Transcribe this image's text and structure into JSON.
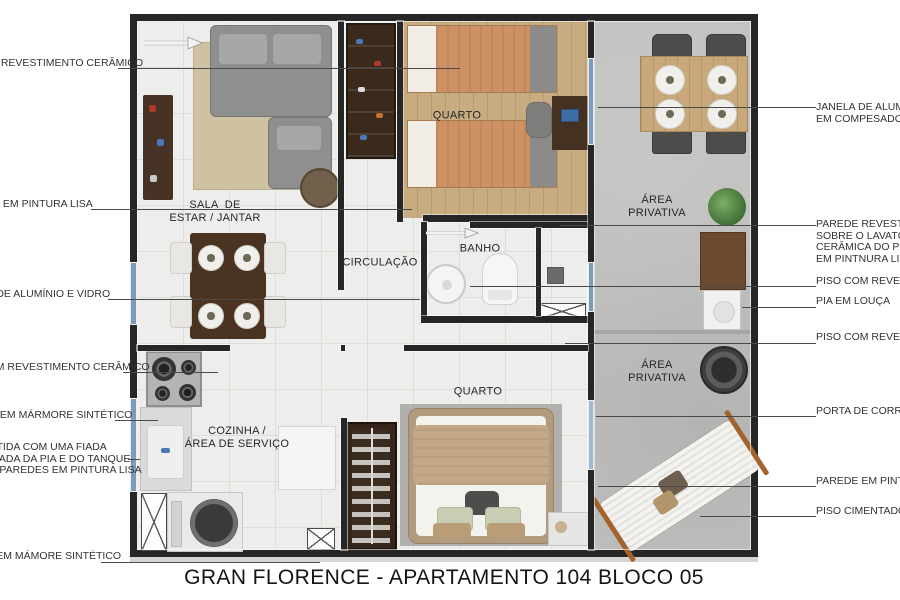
{
  "title": "GRAN FLORENCE - APARTAMENTO 104 BLOCO 05",
  "room_labels": {
    "quarto_top": "QUARTO",
    "sala": "SALA  DE\nESTAR / JANTAR",
    "circulacao": "CIRCULAÇÃO",
    "banho": "BANHO",
    "area_privativa_top": "ÁREA\nPRIVATIVA",
    "area_privativa_mid": "ÁREA\nPRIVATIVA",
    "cozinha": "COZINHA /\nÁREA DE SERVIÇO",
    "quarto_bottom": "QUARTO"
  },
  "annotations_left": [
    {
      "text": "OM REVESTIMENTO CERÂMICO"
    },
    {
      "text": "E EM PINTURA LISA"
    },
    {
      "text": "A DE ALUMÍNIO E VIDRO"
    },
    {
      "text": "COM REVESTIMENTO CERÂMICO"
    },
    {
      "text": "DA EM MÁRMORE SINTÉTICO"
    },
    {
      "text": "E REVESTIDA COM UMA FIADA\nE A BANCADA DA PIA E DO TANQUE.\nNTE DAS PAREDES EM PINTURA LISA"
    },
    {
      "text": "NQUE EM MÁMORE SINTÉTICO"
    }
  ],
  "annotations_right": [
    {
      "text": "JANELA DE ALUMÍNIO E\nEM COMPESADO DE MA"
    },
    {
      "text": "PAREDE REVESTIDA CO\nSOBRE O LAVATÓRIO. R\nCERÂMICA DO PISO AO\nEM PINTNURA LISA"
    },
    {
      "text": "PISO COM REVESTIMEN"
    },
    {
      "text": "PIA EM LOUÇA"
    },
    {
      "text": "PISO COM REVESTIME"
    },
    {
      "text": "PORTA DE CORRER EM"
    },
    {
      "text": "PAREDE EM PINTURA L"
    },
    {
      "text": "PISO CIMENTADO E / O"
    }
  ],
  "colors": {
    "wall": "#262626",
    "window_glass": "#7b9cba",
    "tile_floor": "#edeeec",
    "wood_floor": "#c7ab81",
    "concrete_floor": "#bfbfbd",
    "dark_wood_furniture": "#4a3320",
    "bed_blanket_orange": "#cd9164",
    "bed_blanket_tan": "#c2a886",
    "leader_line": "#4a4a4a"
  }
}
